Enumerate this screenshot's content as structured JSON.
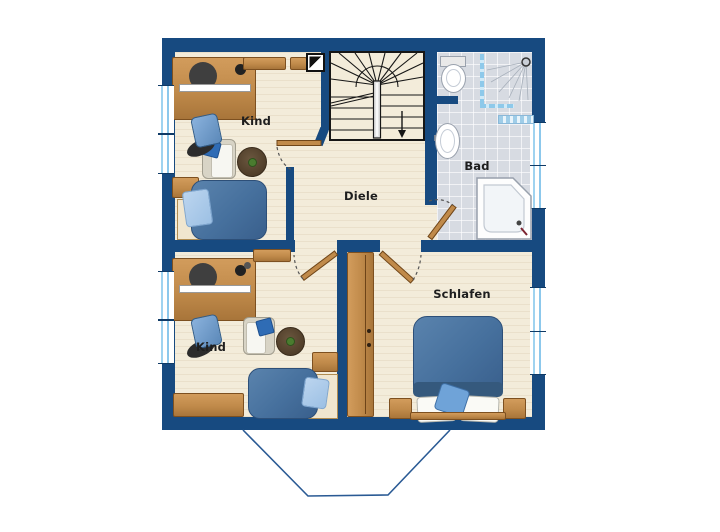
{
  "page": {
    "type": "floor-plan",
    "floor_description": "upper floor plan with stair, two children rooms, hall, bath and bedroom"
  },
  "rooms": [
    {
      "id": "kind-top",
      "label": "Kind"
    },
    {
      "id": "diele",
      "label": "Diele"
    },
    {
      "id": "bad",
      "label": "Bad"
    },
    {
      "id": "kind-bottom",
      "label": "Kind"
    },
    {
      "id": "schlafen",
      "label": "Schlafen"
    }
  ],
  "fixtures": [
    "staircase-with-down-arrow",
    "chimney-symbol",
    "toilet",
    "wash-basin",
    "corner-shower",
    "shower-head",
    "bath-mat",
    "corner-bathtub",
    "door-swing-kind-top",
    "door-swing-kind-bottom",
    "door-swing-schlafen",
    "door-swing-bad",
    "window-left-1",
    "window-left-2",
    "window-left-3",
    "window-left-4",
    "window-right-1",
    "window-right-2",
    "window-right-3",
    "window-right-4",
    "roof-dormer-outline"
  ],
  "furniture": [
    "desk-kind-top",
    "desk-chair-kind-top",
    "wall-shelves-kind-top",
    "armchair-kind-top",
    "round-rug-kind-top",
    "single-bed-kind-top",
    "nightstand-kind-top",
    "desk-kind-bottom",
    "desk-chair-kind-bottom",
    "wall-shelf-kind-bottom",
    "armchair-kind-bottom",
    "round-rug-kind-bottom",
    "single-bed-kind-bottom",
    "nightstand-kind-bottom",
    "sideboard-kind-bottom",
    "wardrobe-schlafen",
    "double-bed-schlafen",
    "nightstand-left-schlafen",
    "nightstand-right-schlafen"
  ],
  "colors": {
    "wall": "#174a80",
    "wood_floor": "#f3ecda",
    "tile_floor": "#d7dbe2",
    "furniture_wood": "#c08a4a",
    "bed_blue": "#46709d",
    "pillow_blue": "#9cc0e4",
    "window_glass": "#9fd3f0",
    "roof_line": "#2a5a94",
    "label_text": "#1e1e1e"
  }
}
